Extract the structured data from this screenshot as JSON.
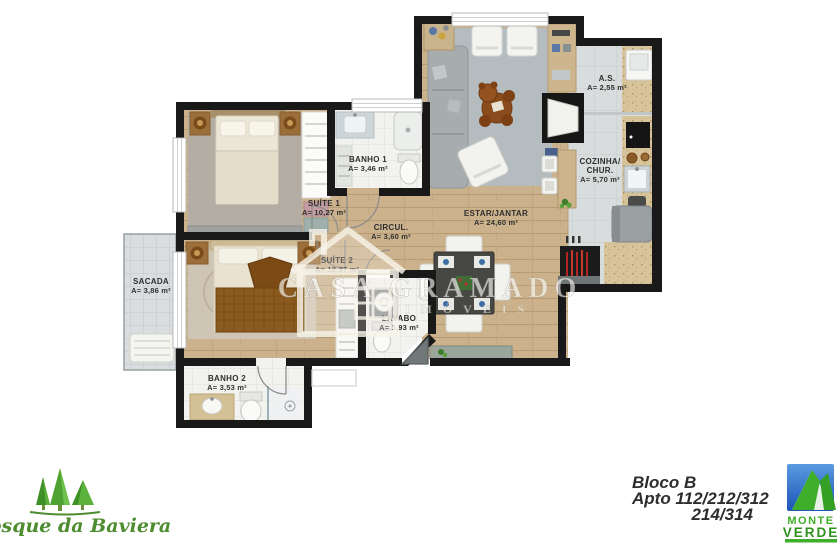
{
  "rooms": {
    "suite1": {
      "name": "SUÍTE 1",
      "area": "A= 10,27 m²"
    },
    "banho1": {
      "name": "BANHO 1",
      "area": "A= 3,46 m²"
    },
    "estar": {
      "name": "ESTAR/JANTAR",
      "area": "A= 24,60 m²"
    },
    "as": {
      "name": "A.S.",
      "area": "A= 2,55 m²"
    },
    "cozinha": {
      "name1": "COZINHA/",
      "name2": "CHUR.",
      "area": "A= 5,70 m²"
    },
    "circul": {
      "name": "CIRCUL.",
      "area": "A= 3,60 m²"
    },
    "suite2": {
      "name": "SUÍTE 2",
      "area": "A= 12,37 m²"
    },
    "sacada": {
      "name": "SACADA",
      "area": "A= 3,86 m²"
    },
    "lavabo": {
      "name": "LAVABO",
      "area": "A= 1,93 m²"
    },
    "banho2": {
      "name": "BANHO 2",
      "area": "A= 3,53 m²"
    }
  },
  "watermark": {
    "brand": "CASA GRAMADO",
    "sub": "IMÓVEIS"
  },
  "unit_info": {
    "block": "Bloco B",
    "apartments": "Apto 112/212/312",
    "apartments2": "214/314"
  },
  "logos": {
    "bosque": {
      "text": "Bosque da Baviera",
      "green": "#4e8c30"
    },
    "monte_verde": {
      "line1": "MONTE",
      "line2": "VERDE",
      "sky_blue": "#2a6fd0",
      "green": "#3fae2a"
    }
  },
  "colors": {
    "wall": "#191919",
    "wood_floor": "#cbb28c",
    "bath_tile": "#f2f2ef",
    "kitchen_tile": "#d8dcdc",
    "counter_beige": "#d7c49a",
    "rug_gray": "#b4bcbf"
  }
}
